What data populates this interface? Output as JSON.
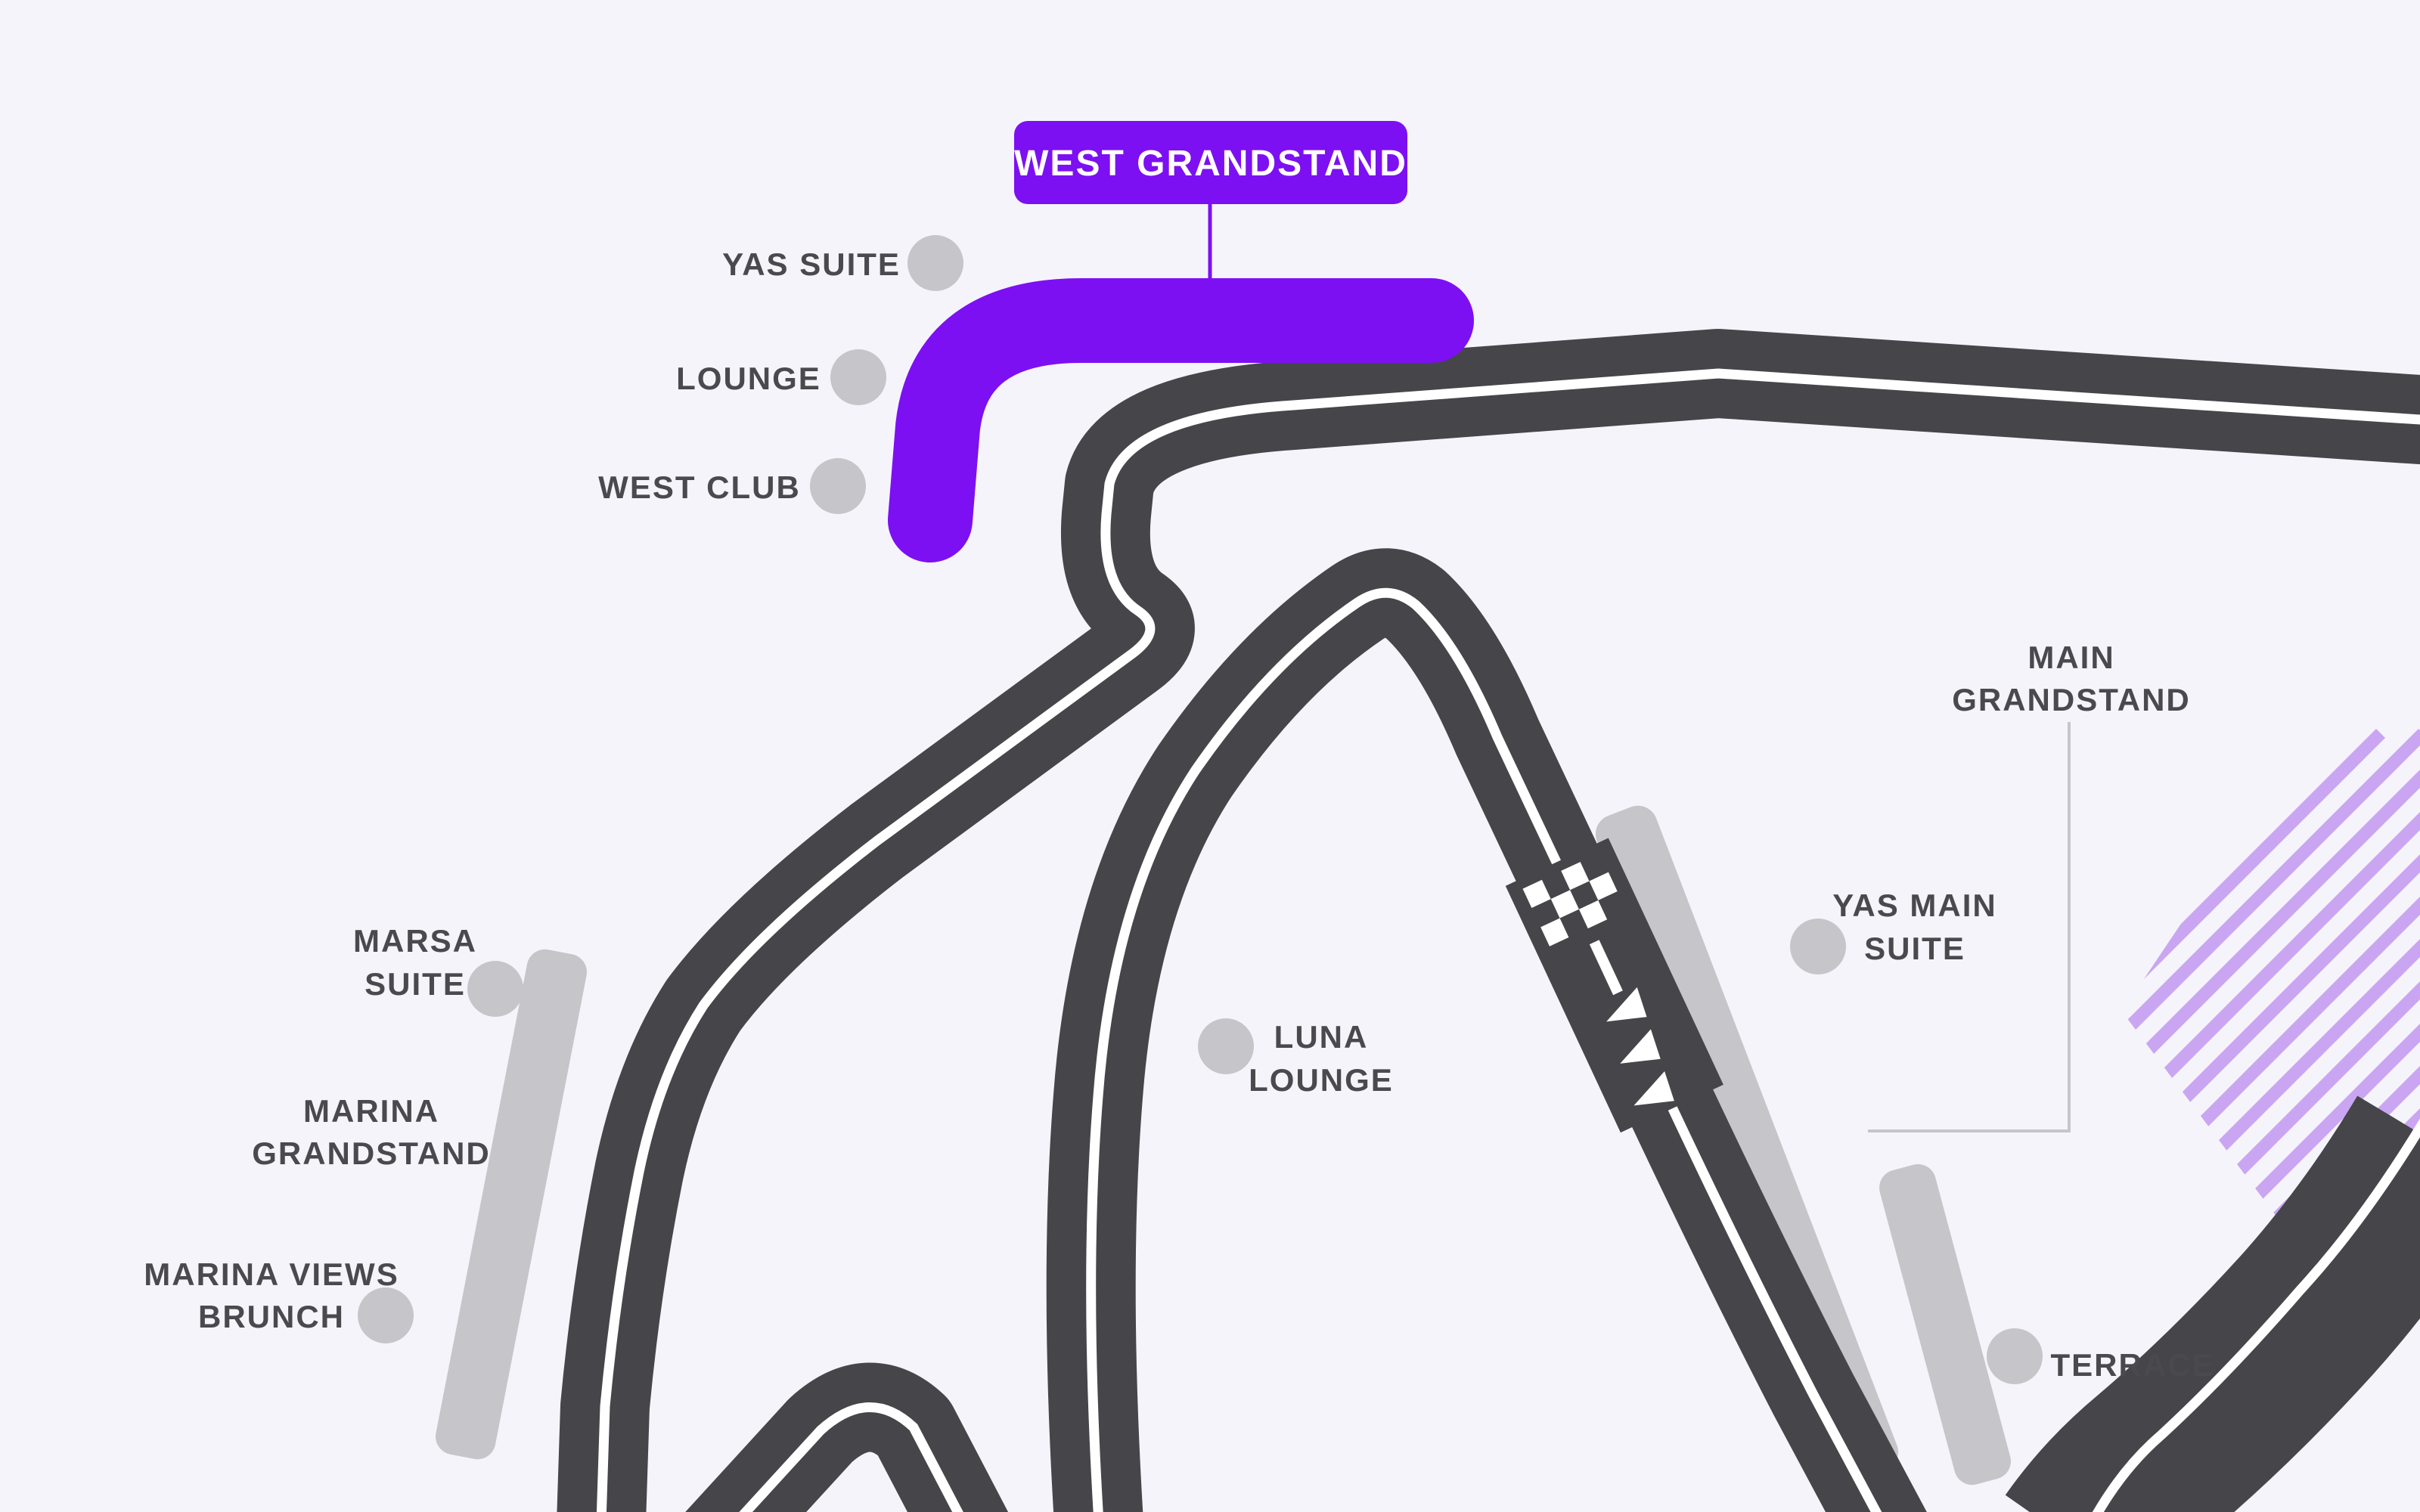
{
  "map": {
    "background_color": "#F5F4FB",
    "track_color": "#464549",
    "line_color": "#FFFFFF",
    "accent_color": "#7C10F2",
    "stripe_color": "#CAA6F2",
    "marker_color": "#C6C5C9",
    "leader_line_color": "#C6C5C9",
    "text_color": "#4A4A4E",
    "selected": {
      "label": "WEST GRANDSTAND"
    },
    "venues": [
      {
        "id": "yas-suite",
        "lines": [
          "YAS SUITE"
        ]
      },
      {
        "id": "lounge",
        "lines": [
          "LOUNGE"
        ]
      },
      {
        "id": "west-club",
        "lines": [
          "WEST CLUB"
        ]
      },
      {
        "id": "marsa-suite",
        "lines": [
          "MARSA",
          "SUITE"
        ]
      },
      {
        "id": "marina-grandstand",
        "lines": [
          "MARINA",
          "GRANDSTAND"
        ]
      },
      {
        "id": "marina-views-brunch",
        "lines": [
          "MARINA VIEWS",
          "BRUNCH"
        ]
      },
      {
        "id": "luna-lounge",
        "lines": [
          "LUNA",
          "LOUNGE"
        ]
      },
      {
        "id": "main-grandstand",
        "lines": [
          "MAIN",
          "GRANDSTAND"
        ]
      },
      {
        "id": "yas-main-suite",
        "lines": [
          "YAS MAIN",
          "SUITE"
        ]
      },
      {
        "id": "terrace",
        "lines": [
          "TERRACE"
        ]
      }
    ],
    "track_features": [
      "start-finish-checkers",
      "direction-arrows"
    ]
  }
}
